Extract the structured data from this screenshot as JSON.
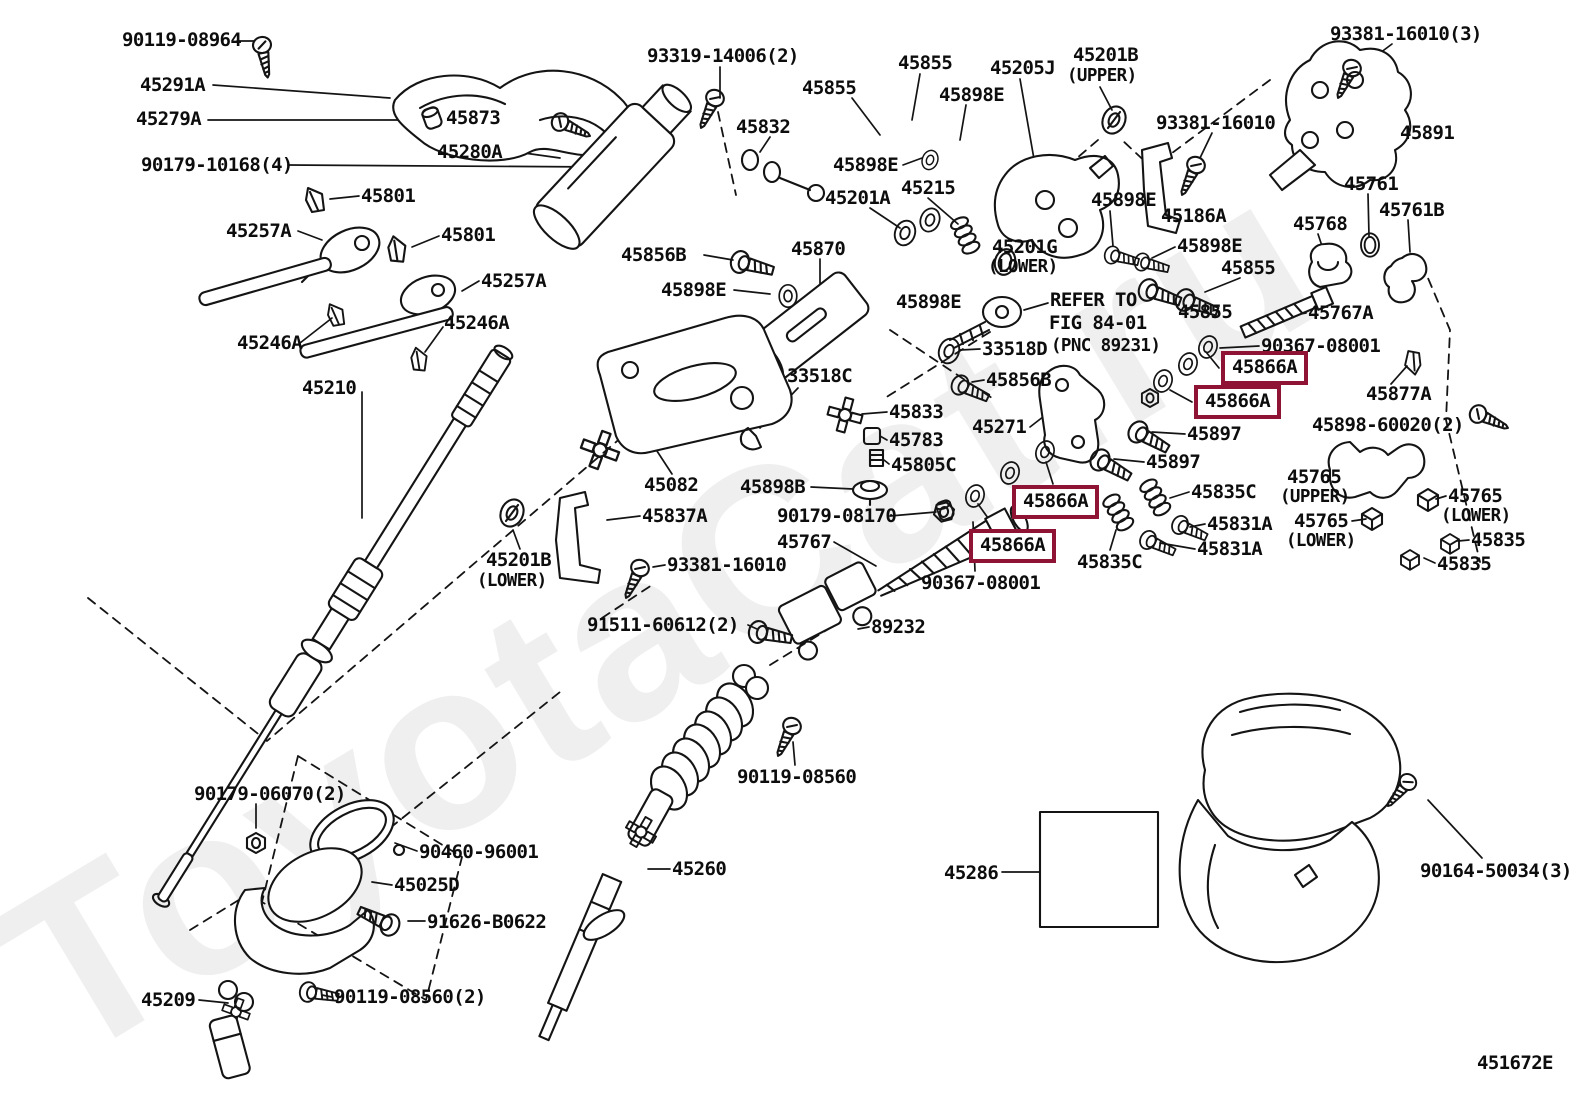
{
  "diagram": {
    "watermark": "ToyotaCat.ru",
    "highlight_color": "#8E1335",
    "line_color": "#141414",
    "code": "451672E",
    "labels": [
      {
        "t": "90119-08964",
        "x": 122,
        "y": 30
      },
      {
        "t": "45291A",
        "x": 140,
        "y": 75
      },
      {
        "t": "45279A",
        "x": 136,
        "y": 109
      },
      {
        "t": "90179-10168(4)",
        "x": 141,
        "y": 155
      },
      {
        "t": "45873",
        "x": 446,
        "y": 108
      },
      {
        "t": "45280A",
        "x": 437,
        "y": 142
      },
      {
        "t": "45801",
        "x": 361,
        "y": 186
      },
      {
        "t": "45257A",
        "x": 226,
        "y": 221
      },
      {
        "t": "45801",
        "x": 441,
        "y": 225
      },
      {
        "t": "45257A",
        "x": 481,
        "y": 271
      },
      {
        "t": "45246A",
        "x": 237,
        "y": 333
      },
      {
        "t": "45246A",
        "x": 444,
        "y": 313
      },
      {
        "t": "45210",
        "x": 302,
        "y": 378
      },
      {
        "t": "93319-14006(2)",
        "x": 647,
        "y": 46
      },
      {
        "t": "45832",
        "x": 736,
        "y": 117
      },
      {
        "t": "45855",
        "x": 898,
        "y": 53
      },
      {
        "t": "45855",
        "x": 802,
        "y": 78
      },
      {
        "t": "45898E",
        "x": 939,
        "y": 85
      },
      {
        "t": "45205J",
        "x": 990,
        "y": 58
      },
      {
        "t": "45201B",
        "x": 1073,
        "y": 45
      },
      {
        "t": "(UPPER)",
        "x": 1067,
        "y": 66
      },
      {
        "t": "93381-16010(3)",
        "x": 1330,
        "y": 24
      },
      {
        "t": "93381-16010",
        "x": 1156,
        "y": 113
      },
      {
        "t": "45891",
        "x": 1400,
        "y": 123
      },
      {
        "t": "45898E",
        "x": 833,
        "y": 155
      },
      {
        "t": "45201A",
        "x": 825,
        "y": 188
      },
      {
        "t": "45215",
        "x": 901,
        "y": 178
      },
      {
        "t": "45898E",
        "x": 1091,
        "y": 190
      },
      {
        "t": "45186A",
        "x": 1161,
        "y": 206
      },
      {
        "t": "45898E",
        "x": 1177,
        "y": 236
      },
      {
        "t": "45855",
        "x": 1221,
        "y": 258
      },
      {
        "t": "45761",
        "x": 1344,
        "y": 174
      },
      {
        "t": "45761B",
        "x": 1379,
        "y": 200
      },
      {
        "t": "45768",
        "x": 1293,
        "y": 214
      },
      {
        "t": "45856B",
        "x": 621,
        "y": 245
      },
      {
        "t": "45898E",
        "x": 661,
        "y": 280
      },
      {
        "t": "45870",
        "x": 791,
        "y": 239
      },
      {
        "t": "45201G",
        "x": 992,
        "y": 237
      },
      {
        "t": "(LOWER)",
        "x": 988,
        "y": 257
      },
      {
        "t": "45855",
        "x": 1178,
        "y": 302
      },
      {
        "t": "45767A",
        "x": 1308,
        "y": 303
      },
      {
        "t": "REFER TO",
        "x": 1050,
        "y": 290
      },
      {
        "t": "FIG 84-01",
        "x": 1049,
        "y": 313
      },
      {
        "t": "(PNC 89231)",
        "x": 1051,
        "y": 336
      },
      {
        "t": "45898E",
        "x": 896,
        "y": 292
      },
      {
        "t": "33518D",
        "x": 982,
        "y": 339
      },
      {
        "t": "90367-08001",
        "x": 1261,
        "y": 336
      },
      {
        "t": "45866A",
        "x": 1221,
        "y": 351,
        "b": 1
      },
      {
        "t": "45866A",
        "x": 1194,
        "y": 385,
        "b": 1
      },
      {
        "t": "45877A",
        "x": 1366,
        "y": 384
      },
      {
        "t": "45898-60020(2)",
        "x": 1312,
        "y": 415
      },
      {
        "t": "45856B",
        "x": 986,
        "y": 370
      },
      {
        "t": "33518C",
        "x": 787,
        "y": 366
      },
      {
        "t": "45833",
        "x": 889,
        "y": 402
      },
      {
        "t": "45271",
        "x": 972,
        "y": 417
      },
      {
        "t": "45783",
        "x": 889,
        "y": 430
      },
      {
        "t": "45805C",
        "x": 891,
        "y": 455
      },
      {
        "t": "45897",
        "x": 1187,
        "y": 424
      },
      {
        "t": "45897",
        "x": 1146,
        "y": 452
      },
      {
        "t": "45082",
        "x": 644,
        "y": 475
      },
      {
        "t": "45898B",
        "x": 740,
        "y": 477
      },
      {
        "t": "90179-08170",
        "x": 777,
        "y": 506
      },
      {
        "t": "45767",
        "x": 777,
        "y": 532
      },
      {
        "t": "45866A",
        "x": 1012,
        "y": 485,
        "b": 1
      },
      {
        "t": "45866A",
        "x": 969,
        "y": 529,
        "b": 1
      },
      {
        "t": "90367-08001",
        "x": 921,
        "y": 573
      },
      {
        "t": "45835C",
        "x": 1191,
        "y": 482
      },
      {
        "t": "45831A",
        "x": 1207,
        "y": 514
      },
      {
        "t": "45831A",
        "x": 1197,
        "y": 539
      },
      {
        "t": "45835C",
        "x": 1077,
        "y": 552
      },
      {
        "t": "45765",
        "x": 1287,
        "y": 467
      },
      {
        "t": "(UPPER)",
        "x": 1280,
        "y": 487
      },
      {
        "t": "45765",
        "x": 1448,
        "y": 486
      },
      {
        "t": "(LOWER)",
        "x": 1441,
        "y": 506
      },
      {
        "t": "45765",
        "x": 1294,
        "y": 511
      },
      {
        "t": "(LOWER)",
        "x": 1286,
        "y": 531
      },
      {
        "t": "45835",
        "x": 1471,
        "y": 530
      },
      {
        "t": "45835",
        "x": 1437,
        "y": 554
      },
      {
        "t": "45837A",
        "x": 642,
        "y": 506
      },
      {
        "t": "45201B",
        "x": 486,
        "y": 550
      },
      {
        "t": "(LOWER)",
        "x": 477,
        "y": 571
      },
      {
        "t": "93381-16010",
        "x": 667,
        "y": 555
      },
      {
        "t": "91511-60612(2)",
        "x": 587,
        "y": 615
      },
      {
        "t": "89232",
        "x": 871,
        "y": 617
      },
      {
        "t": "90119-08560",
        "x": 737,
        "y": 767
      },
      {
        "t": "45260",
        "x": 672,
        "y": 859
      },
      {
        "t": "90179-06070(2)",
        "x": 194,
        "y": 784
      },
      {
        "t": "90460-96001",
        "x": 419,
        "y": 842
      },
      {
        "t": "45025D",
        "x": 394,
        "y": 875
      },
      {
        "t": "91626-B0622",
        "x": 427,
        "y": 912
      },
      {
        "t": "45209",
        "x": 141,
        "y": 990
      },
      {
        "t": "90119-08560(2)",
        "x": 334,
        "y": 987
      },
      {
        "t": "45286",
        "x": 944,
        "y": 863
      },
      {
        "t": "90164-50034(3)",
        "x": 1420,
        "y": 861
      },
      {
        "t": "451672E",
        "x": 1477,
        "y": 1053,
        "n": "diagram-code"
      }
    ]
  }
}
